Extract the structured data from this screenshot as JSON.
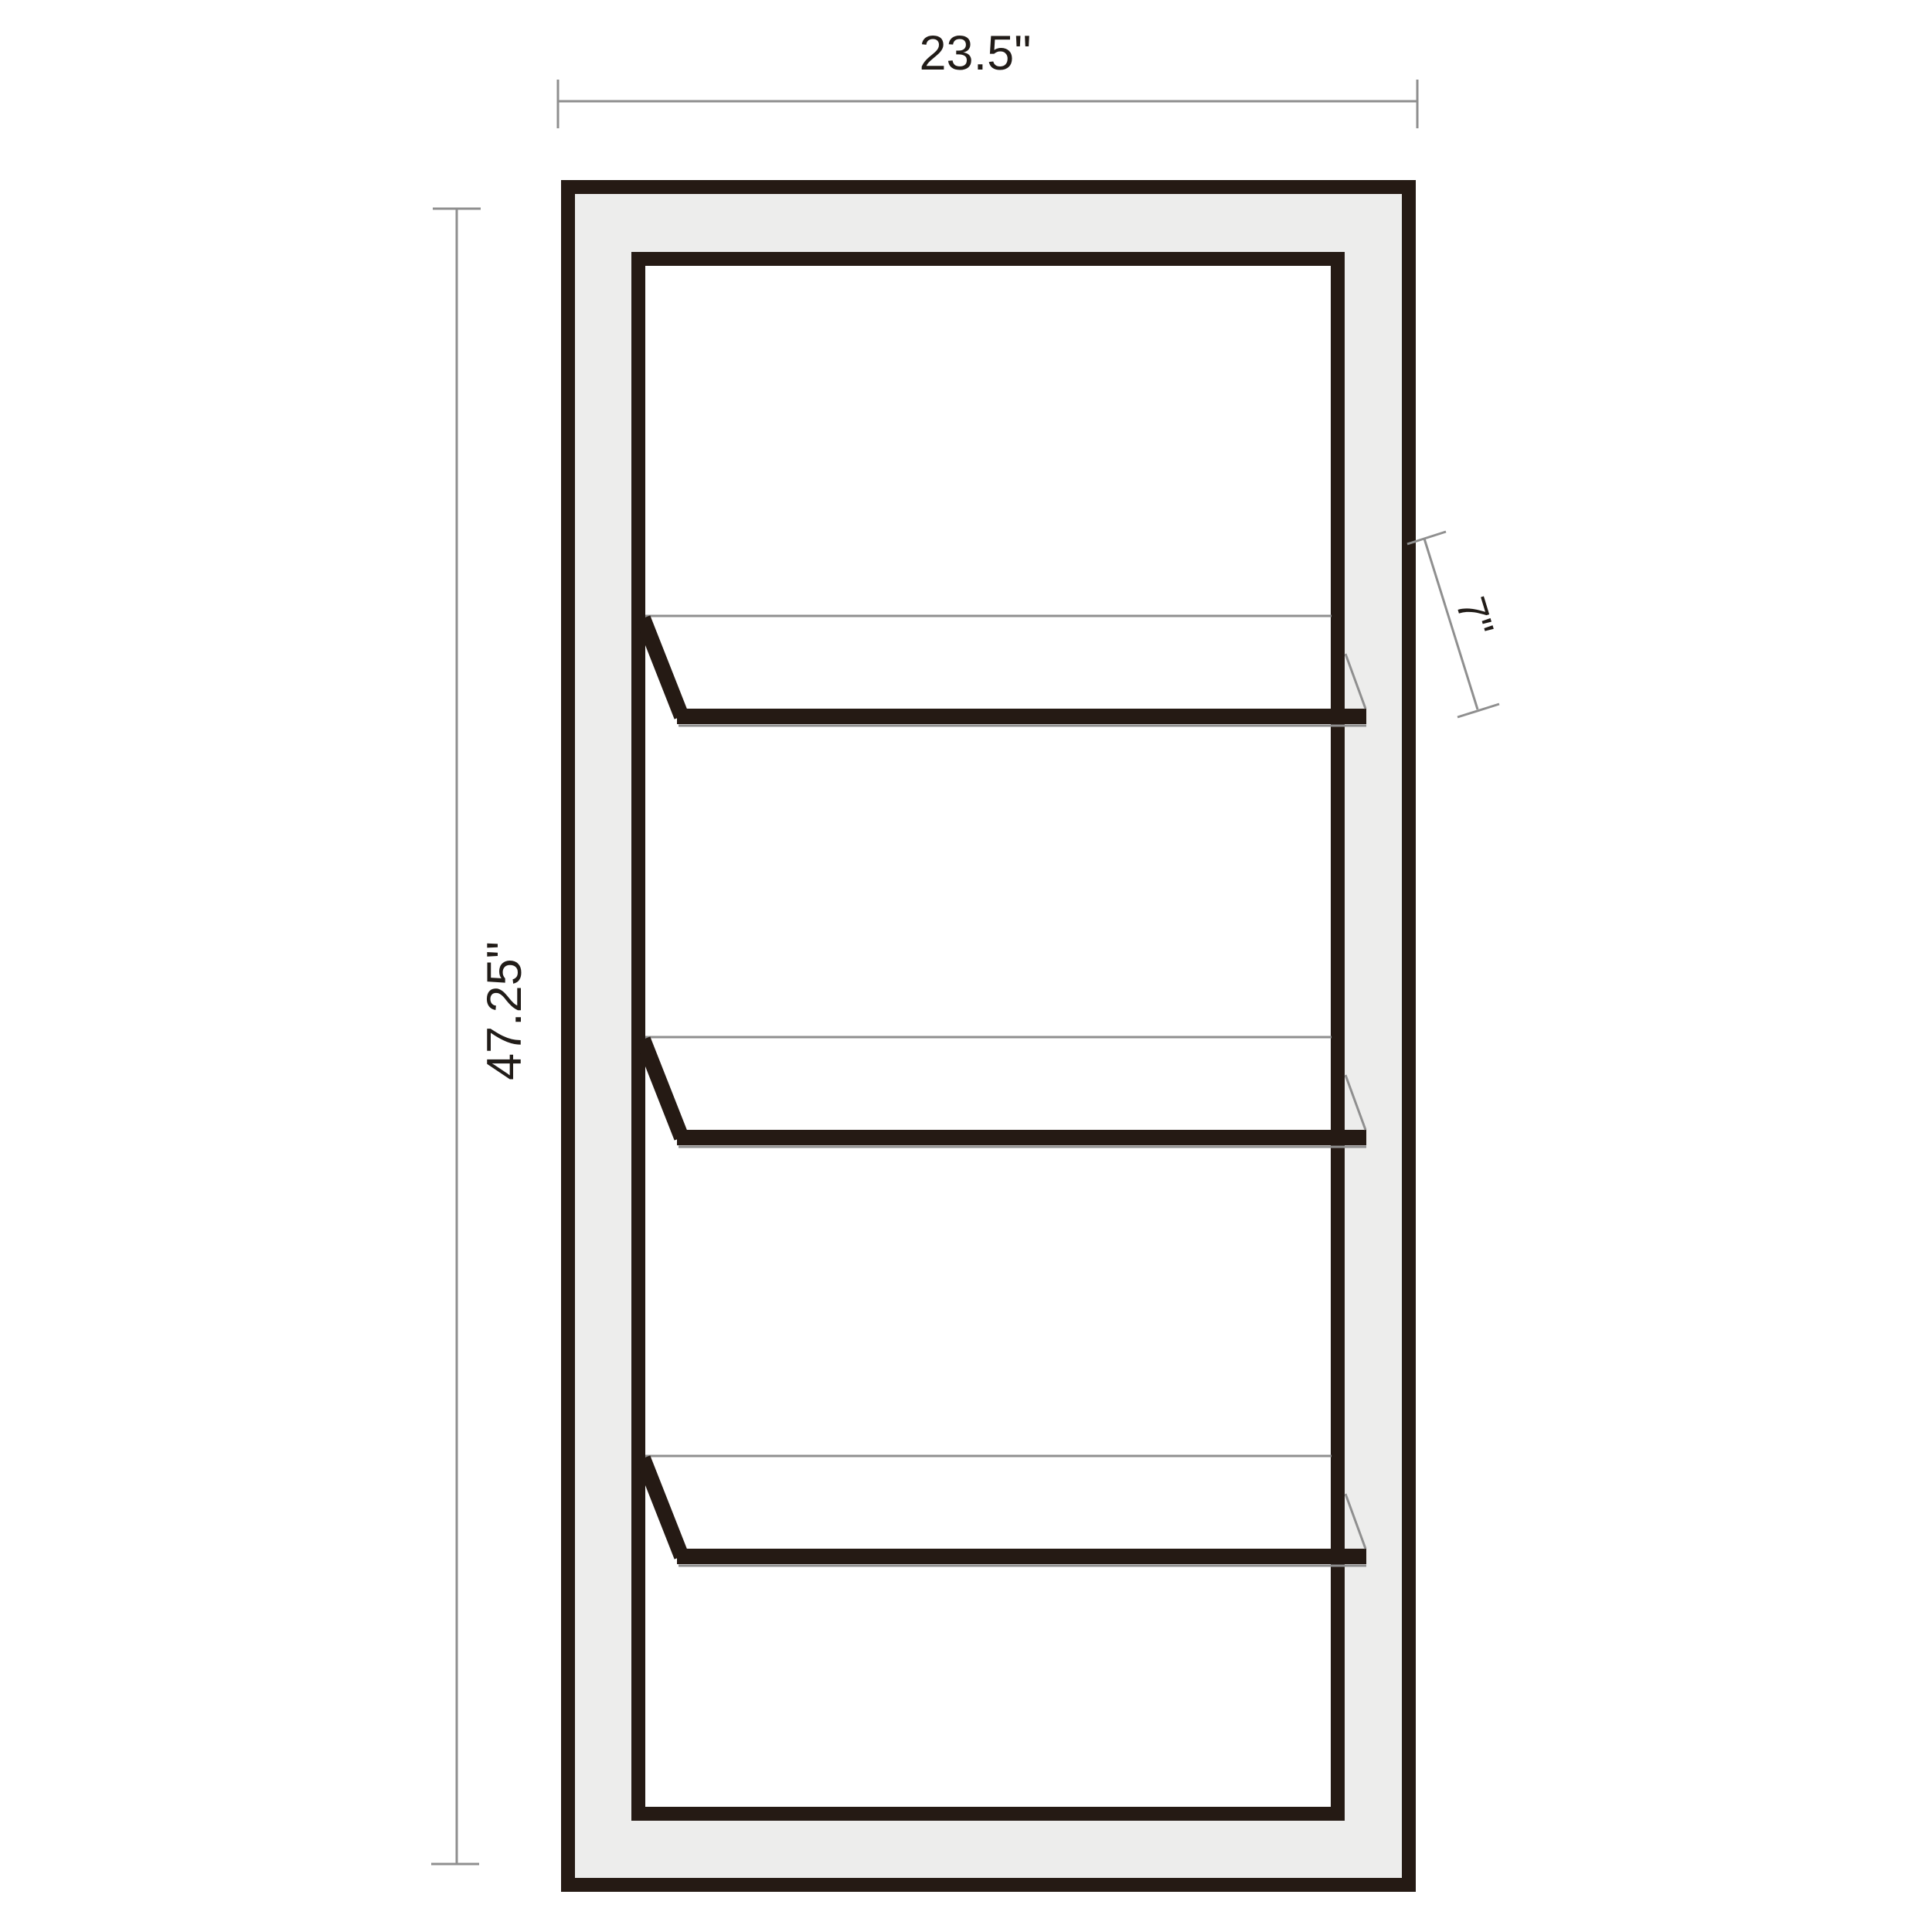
{
  "dimensions": {
    "width_label": "23.5\"",
    "height_label": "47.25\"",
    "shelf_depth_label": "7\""
  },
  "shelves": {
    "count": 3
  },
  "colors": {
    "frame": "#251a14",
    "panel": "#ededec",
    "line": "#8f8f8f",
    "text": "#211c18",
    "background": "#ffffff"
  }
}
